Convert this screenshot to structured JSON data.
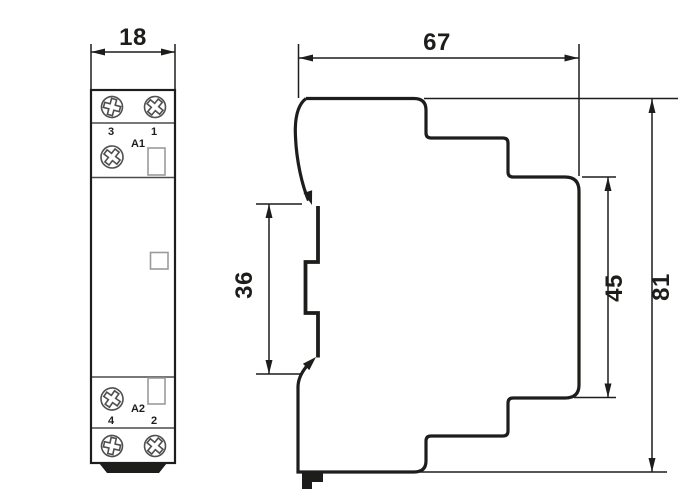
{
  "drawing": {
    "background": "#ffffff",
    "ink": "#1d1d1b",
    "divider_color": "#4a4a4a",
    "screw_color": "#4f4f4f",
    "window_color": "#9b9b9b",
    "dimensions": {
      "width": "18",
      "depth": "67",
      "rail_span": "36",
      "face_height": "45",
      "height": "81"
    },
    "front_view": {
      "terminals": {
        "top_left": "3",
        "top_right": "1",
        "bottom_left": "4",
        "bottom_right": "2"
      },
      "coil_top": "A1",
      "coil_bottom": "A2"
    }
  }
}
